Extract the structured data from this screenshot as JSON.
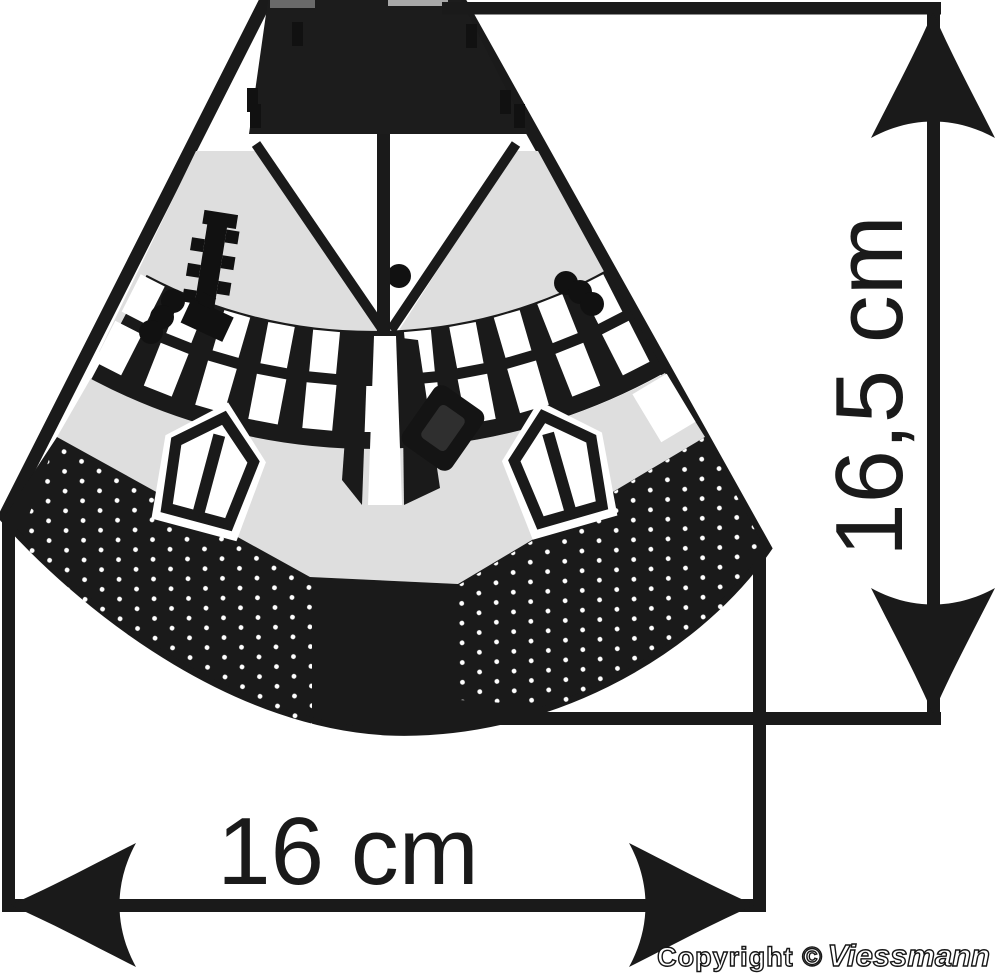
{
  "figure": {
    "title": "product-footprint-dimension-diagram",
    "dimensions": {
      "width": {
        "label": "16 cm"
      },
      "height": {
        "label": "16,5 cm"
      }
    }
  },
  "footer": {
    "copyright": "Copyright ©",
    "brand": "Viessmann"
  },
  "colors": {
    "ink": "#1a1a1a",
    "roof_dark": "#1c1c1c",
    "panel_gray": "#dedede",
    "paper": "#ffffff"
  },
  "icons": {
    "arrow_up": "arrow-up-icon",
    "arrow_down": "arrow-down-icon",
    "arrow_left": "arrow-left-icon",
    "arrow_right": "arrow-right-icon"
  }
}
